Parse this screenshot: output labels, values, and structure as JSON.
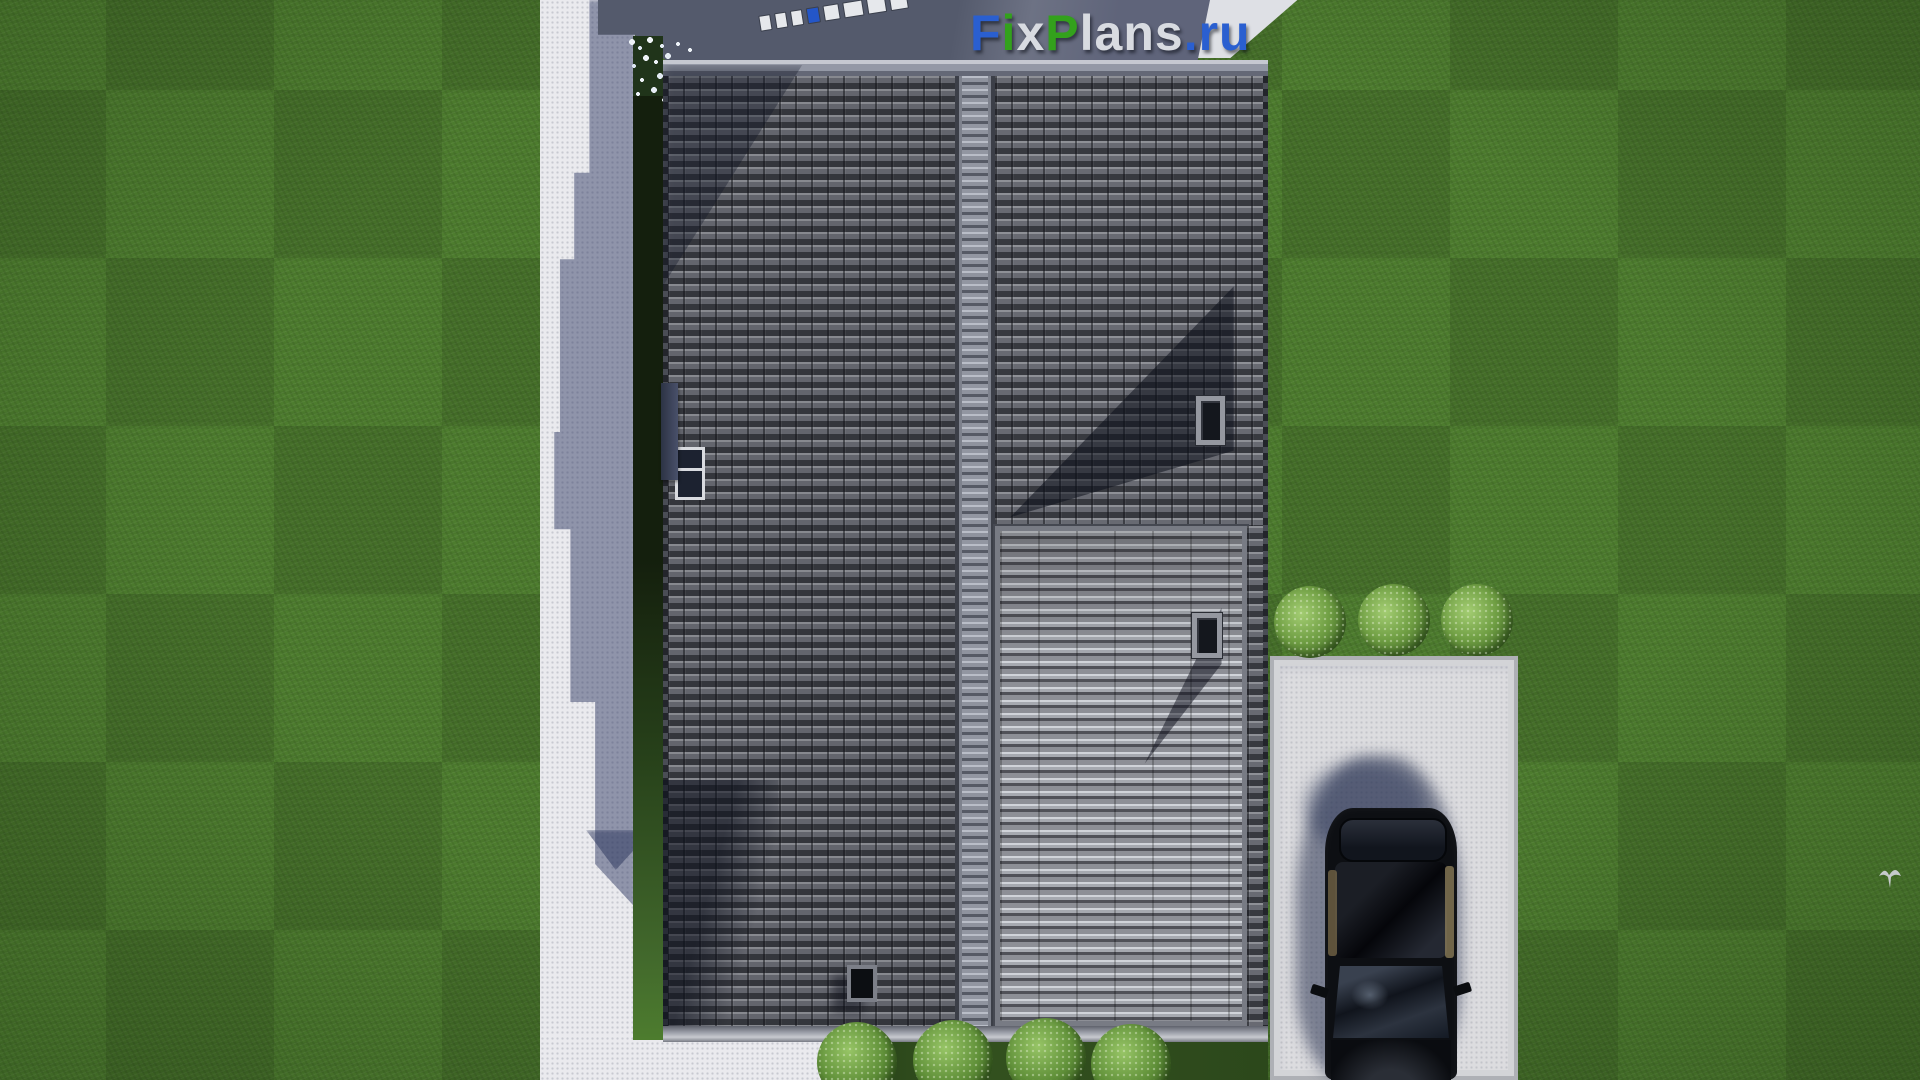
{
  "watermark": {
    "text": "FixPlans.ru",
    "parts": [
      {
        "text": "F",
        "color": "#2a5fd0"
      },
      {
        "text": "i",
        "color": "#33a11c"
      },
      {
        "text": "x",
        "color": "#d8dbe1"
      },
      {
        "text": "P",
        "color": "#33a11c"
      },
      {
        "text": "lans",
        "color": "#d8dbe1"
      },
      {
        "text": ".",
        "color": "#2a5fd0"
      },
      {
        "text": "ru",
        "color": "#2a5fd0"
      }
    ]
  },
  "scene": {
    "type": "3d-architectural-render-top-down-site-plan",
    "objects": [
      "lawn-with-mowing-pattern",
      "concrete-footpath-left",
      "concrete-patio-bottom-left",
      "terrace-band-top",
      "sun-lounger-row",
      "flower-bed-white-blossoms",
      "gable-roof-tiled-left-plane",
      "ridge-cap",
      "gable-roof-tiled-right-plane",
      "corrugated-metal-roof-section",
      "chimney-upper",
      "chimney-lower",
      "skylight-window",
      "side-dormer-box",
      "roof-vent",
      "driveway-concrete-pad",
      "black-car-top-view",
      "round-bush-1",
      "round-bush-2",
      "round-bush-3",
      "hedge-bush-1",
      "hedge-bush-2",
      "hedge-bush-3",
      "hedge-bush-4",
      "flying-bird"
    ],
    "palette": {
      "grass": "#4d7c2e",
      "concrete": "#eaeaee",
      "terrace": "#5a5f72",
      "roof_tile": "#5a5c64",
      "roof_metal": "#9aa0a8",
      "ridge": "#9296a1",
      "shadow": "#232c4a",
      "car_body": "#0d0f13",
      "car_interior": "#7a6a4a",
      "bush": "#6f9e43",
      "logo_blue": "#2a5fd0",
      "logo_green": "#33a11c",
      "logo_gray": "#d8dbe1"
    }
  }
}
